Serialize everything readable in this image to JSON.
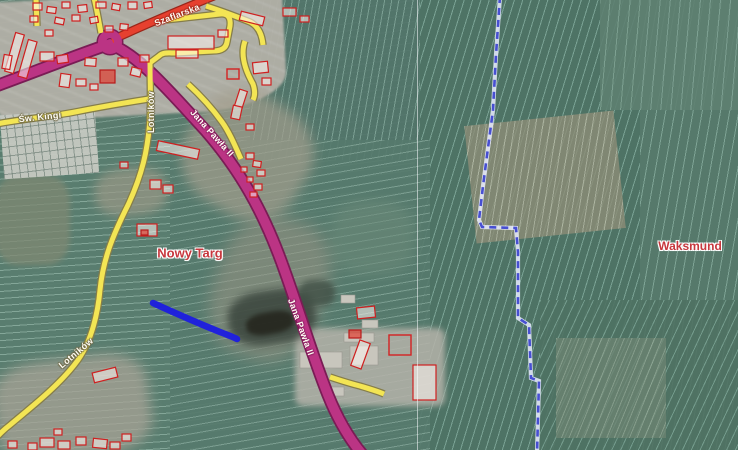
{
  "map_data": {
    "place_labels": [
      {
        "text": "Nowy Targ",
        "x": 190,
        "y": 253,
        "rot": 0,
        "size": 13
      },
      {
        "text": "Waksmund",
        "x": 690,
        "y": 246,
        "rot": 0,
        "size": 12
      }
    ],
    "road_labels": [
      {
        "text": "Szaflarska",
        "x": 177,
        "y": 15,
        "rot": -21,
        "cls": "halo-red"
      },
      {
        "text": "Św. Kingi",
        "x": 40,
        "y": 117,
        "rot": -6,
        "cls": "halo-yellow"
      },
      {
        "text": "Lotników",
        "x": 151,
        "y": 112,
        "rot": -90,
        "cls": "halo-yellow"
      },
      {
        "text": "Lotników",
        "x": 76,
        "y": 353,
        "rot": -40,
        "cls": "halo-yellow"
      },
      {
        "text": "Jana Pawła II",
        "x": 212,
        "y": 133,
        "rot": 48,
        "cls": "halo-magenta"
      },
      {
        "text": "Jana Pawła II",
        "x": 301,
        "y": 327,
        "rot": 70,
        "cls": "halo-magenta"
      }
    ],
    "colors": {
      "primary_road": "#bb3484",
      "primary_casing": "#7a1c55",
      "red_road": "#e6402f",
      "red_casing": "#99261a",
      "secondary_road": "#f3e554",
      "secondary_casing": "#857d4a",
      "boundary_blue": "#474fd2",
      "boundary_halo": "#e9ecff",
      "selected_way": "#1c1ce0",
      "building_red": "#cf2020",
      "place_label": "#c7373d"
    },
    "roads": [
      {
        "id": "jana-pawla-ii",
        "type": "primary",
        "d": "M-4,86 C45,68 85,52 110,44 C140,56 170,92 205,130 C240,170 262,210 280,258 C298,306 310,350 328,395 C340,425 352,442 362,454"
      },
      {
        "id": "szaflarska",
        "type": "trunk",
        "d": "M112,40 C140,27 175,12 214,-4"
      },
      {
        "id": "sw-kingi",
        "type": "secondary",
        "d": "M-4,124 C30,118 55,116 75,112 C105,106 130,102 149,99"
      },
      {
        "id": "lotnikow",
        "type": "secondary",
        "d": "M150,60 C150,85 151,100 150,118 C148,150 142,175 128,205 C112,237 103,260 100,290 C98,312 92,340 78,360 C60,385 30,408 10,425 C2,431 -2,436 -6,440"
      },
      {
        "id": "school-loop",
        "type": "secondary",
        "d": "M166,20 L220,14 C228,13 231,18 230,26 L227,42 C226,49 220,51 213,51 L175,53 C168,53 163,52 159,56 L151,62"
      },
      {
        "id": "roundabout-north",
        "type": "secondary",
        "d": "M101,33 C99,22 97,10 94,-2"
      },
      {
        "id": "top-stub",
        "type": "secondary",
        "d": "M37,26 L36,-2"
      },
      {
        "id": "east-1",
        "type": "secondary",
        "d": "M206,6 C225,12 240,18 250,22 C258,26 262,34 263,45"
      },
      {
        "id": "east-2",
        "type": "secondary",
        "d": "M245,41 C240,55 245,70 253,84 C255,90 255,96 253,100"
      },
      {
        "id": "east-3",
        "type": "secondary",
        "d": "M188,84 C200,95 212,108 222,122 C230,133 236,148 241,159"
      },
      {
        "id": "industrial-access",
        "type": "secondary",
        "d": "M330,377 C345,382 352,384 360,386 C370,389 377,391 384,394"
      }
    ],
    "roundabout": {
      "cx": 110,
      "cy": 42,
      "r": 8
    },
    "boundary": {
      "d": "M500,-4 L496,55 L493,110 L483,186 L479,220 L482,227 L516,228 L518,252 L518,318 L529,325 L531,378 L539,381 L537,454",
      "dash": "7 5"
    },
    "selected_way": {
      "d": "M153,303 C175,313 200,324 220,332 C228,335 233,337 237,339"
    },
    "seam_line": {
      "x": 417.5
    },
    "buildings": [
      [
        33,
        3,
        9,
        7,
        0,
        0
      ],
      [
        47,
        7,
        9,
        6,
        8,
        0
      ],
      [
        62,
        2,
        8,
        6,
        0,
        0
      ],
      [
        78,
        5,
        9,
        7,
        -6,
        0
      ],
      [
        96,
        2,
        10,
        6,
        0,
        0
      ],
      [
        112,
        4,
        8,
        6,
        10,
        0
      ],
      [
        128,
        2,
        9,
        7,
        0,
        0
      ],
      [
        144,
        2,
        8,
        6,
        -8,
        0
      ],
      [
        30,
        16,
        8,
        6,
        0,
        0
      ],
      [
        55,
        18,
        9,
        6,
        12,
        0
      ],
      [
        72,
        15,
        8,
        6,
        0,
        0
      ],
      [
        90,
        17,
        8,
        6,
        -10,
        0
      ],
      [
        105,
        26,
        8,
        6,
        0,
        0
      ],
      [
        120,
        24,
        8,
        6,
        6,
        0
      ],
      [
        45,
        30,
        8,
        6,
        0,
        0
      ],
      [
        10,
        33,
        9,
        40,
        16,
        0
      ],
      [
        23,
        40,
        9,
        38,
        16,
        0
      ],
      [
        3,
        55,
        8,
        14,
        10,
        0
      ],
      [
        40,
        52,
        14,
        9,
        0,
        0
      ],
      [
        57,
        55,
        11,
        8,
        -8,
        0
      ],
      [
        85,
        58,
        11,
        8,
        4,
        0
      ],
      [
        100,
        70,
        15,
        13,
        0,
        1
      ],
      [
        118,
        58,
        10,
        8,
        0,
        0
      ],
      [
        131,
        68,
        10,
        8,
        14,
        0
      ],
      [
        60,
        74,
        10,
        13,
        8,
        0
      ],
      [
        76,
        79,
        10,
        7,
        0,
        0
      ],
      [
        90,
        84,
        8,
        6,
        0,
        0
      ],
      [
        140,
        55,
        9,
        7,
        0,
        0
      ],
      [
        168,
        36,
        46,
        13,
        0,
        0
      ],
      [
        176,
        50,
        22,
        8,
        0,
        0
      ],
      [
        218,
        30,
        10,
        7,
        0,
        0
      ],
      [
        240,
        14,
        24,
        9,
        14,
        0
      ],
      [
        283,
        8,
        13,
        8,
        0,
        0
      ],
      [
        300,
        16,
        9,
        6,
        0,
        0
      ],
      [
        253,
        62,
        15,
        11,
        -6,
        0
      ],
      [
        227,
        69,
        12,
        10,
        0,
        2
      ],
      [
        262,
        78,
        9,
        7,
        0,
        0
      ],
      [
        237,
        90,
        8,
        17,
        18,
        0
      ],
      [
        232,
        106,
        9,
        13,
        12,
        0
      ],
      [
        246,
        124,
        8,
        6,
        0,
        0
      ],
      [
        157,
        145,
        42,
        10,
        12,
        0
      ],
      [
        150,
        180,
        11,
        9,
        0,
        0
      ],
      [
        163,
        185,
        10,
        8,
        0,
        0
      ],
      [
        120,
        162,
        8,
        6,
        0,
        0
      ],
      [
        137,
        224,
        20,
        12,
        0,
        0
      ],
      [
        141,
        230,
        7,
        5,
        0,
        1
      ],
      [
        246,
        153,
        8,
        6,
        0,
        0
      ],
      [
        253,
        161,
        8,
        6,
        8,
        0
      ],
      [
        241,
        167,
        6,
        5,
        0,
        0
      ],
      [
        257,
        170,
        8,
        6,
        0,
        0
      ],
      [
        247,
        177,
        6,
        5,
        0,
        0
      ],
      [
        254,
        184,
        8,
        6,
        0,
        0
      ],
      [
        250,
        192,
        7,
        5,
        0,
        0
      ],
      [
        357,
        307,
        18,
        11,
        -6,
        0
      ],
      [
        349,
        330,
        12,
        8,
        0,
        1
      ],
      [
        355,
        341,
        11,
        27,
        20,
        0
      ],
      [
        389,
        335,
        22,
        20,
        0,
        2
      ],
      [
        413,
        365,
        23,
        35,
        0,
        0
      ],
      [
        344,
        333,
        30,
        9,
        0,
        3
      ],
      [
        350,
        346,
        28,
        19,
        0,
        3
      ],
      [
        300,
        352,
        42,
        16,
        0,
        3
      ],
      [
        322,
        387,
        22,
        9,
        0,
        3
      ],
      [
        341,
        295,
        14,
        8,
        0,
        3
      ],
      [
        362,
        320,
        16,
        8,
        0,
        3
      ],
      [
        93,
        370,
        24,
        10,
        -14,
        0
      ],
      [
        40,
        438,
        14,
        9,
        0,
        0
      ],
      [
        58,
        441,
        12,
        8,
        0,
        0
      ],
      [
        76,
        437,
        10,
        8,
        0,
        0
      ],
      [
        93,
        439,
        14,
        9,
        6,
        0
      ],
      [
        110,
        442,
        10,
        7,
        0,
        0
      ],
      [
        54,
        429,
        8,
        6,
        0,
        0
      ],
      [
        28,
        443,
        9,
        7,
        0,
        0
      ],
      [
        8,
        441,
        9,
        7,
        0,
        0
      ],
      [
        122,
        434,
        9,
        7,
        0,
        0
      ]
    ],
    "terrain_patches": [
      {
        "x": -5,
        "y": -5,
        "w": 748,
        "h": 460,
        "rot": 0,
        "base": "#597b6d",
        "angle": 172,
        "stripe": "rgba(205,235,222,0.28)",
        "pitch": 7
      },
      {
        "x": 415,
        "y": -5,
        "w": 330,
        "h": 465,
        "rot": 0,
        "base": "#4e7365",
        "angle": 107,
        "stripe": "rgba(176,220,206,0.45)",
        "pitch": 8
      },
      {
        "x": 640,
        "y": -5,
        "w": 105,
        "h": 465,
        "rot": 0,
        "base": "#56796b",
        "angle": 100,
        "stripe": "rgba(186,226,211,0.4)",
        "pitch": 9
      },
      {
        "x": 600,
        "y": -5,
        "w": 140,
        "h": 115,
        "rot": 0,
        "base": "#5e8071",
        "angle": 95,
        "stripe": "rgba(190,225,210,0.35)",
        "pitch": 10,
        "op": 0.9
      },
      {
        "x": 470,
        "y": 118,
        "w": 150,
        "h": 118,
        "rot": -6,
        "base": "#8d8d77",
        "angle": 105,
        "stripe": "rgba(232,232,212,0.5)",
        "pitch": 7,
        "op": 0.8
      },
      {
        "x": 540,
        "y": 300,
        "w": 205,
        "h": 160,
        "rot": 0,
        "base": "#4f7263",
        "angle": 115,
        "stripe": "rgba(170,215,200,0.45)",
        "pitch": 8,
        "op": 0.9
      },
      {
        "x": 556,
        "y": 338,
        "w": 110,
        "h": 100,
        "rot": 0,
        "base": "#6d8472",
        "angle": 112,
        "stripe": "rgba(210,225,205,0.4)",
        "pitch": 7,
        "op": 0.75
      },
      {
        "x": 250,
        "y": -5,
        "w": 170,
        "h": 165,
        "rot": 0,
        "base": "#52756a",
        "angle": 100,
        "stripe": "rgba(190,228,214,0.4)",
        "pitch": 7,
        "op": 0.9
      },
      {
        "x": 150,
        "y": 140,
        "w": 280,
        "h": 320,
        "rot": 0,
        "base": "#567a6d",
        "angle": 170,
        "stripe": "rgba(200,232,219,0.35)",
        "pitch": 8,
        "op": 0.9
      },
      {
        "x": -5,
        "y": 130,
        "w": 175,
        "h": 330,
        "rot": 0,
        "base": "#5a7e70",
        "angle": 176,
        "stripe": "rgba(205,238,224,0.38)",
        "pitch": 7,
        "op": 0.95
      },
      {
        "x": -5,
        "y": 175,
        "w": 75,
        "h": 90,
        "rot": 0,
        "base": "#7f8872",
        "op": 0.75,
        "blur": 3,
        "round": "30%"
      },
      {
        "x": 330,
        "y": 200,
        "w": 85,
        "h": 75,
        "rot": 0,
        "base": "#6c8a79",
        "op": 0.55,
        "blur": 6,
        "round": "40%"
      },
      {
        "x": 95,
        "y": 168,
        "w": 72,
        "h": 48,
        "rot": -5,
        "base": "#9a9886",
        "op": 0.7,
        "blur": 5,
        "round": "40%"
      },
      {
        "x": -5,
        "y": -5,
        "w": 290,
        "h": 120,
        "rot": -3,
        "base": "#b2b0a7",
        "angle": 25,
        "stripe": "rgba(255,255,255,0.25)",
        "pitch": 11,
        "op": 0.95,
        "blur": 1,
        "round": "0 0 30% 10%"
      },
      {
        "x": 185,
        "y": 95,
        "w": 125,
        "h": 120,
        "rot": 32,
        "base": "#a39e8d",
        "op": 0.7,
        "blur": 6,
        "round": "40%"
      },
      {
        "x": 215,
        "y": 215,
        "w": 110,
        "h": 145,
        "rot": 20,
        "base": "#9a9484",
        "op": 0.55,
        "blur": 8,
        "round": "40%"
      },
      {
        "x": 295,
        "y": 328,
        "w": 150,
        "h": 78,
        "rot": 0,
        "base": "#b5b3aa",
        "op": 0.85,
        "blur": 3,
        "round": "8px"
      },
      {
        "x": -5,
        "y": 358,
        "w": 155,
        "h": 100,
        "rot": -8,
        "base": "#a8a396",
        "op": 0.75,
        "blur": 6,
        "round": "30%"
      },
      {
        "x": 228,
        "y": 290,
        "w": 88,
        "h": 54,
        "rot": -8,
        "base": "#3a453d",
        "op": 0.85,
        "blur": 4,
        "round": "40%"
      },
      {
        "x": 246,
        "y": 312,
        "w": 48,
        "h": 22,
        "rot": -10,
        "base": "#26271f",
        "op": 0.9,
        "blur": 2,
        "round": "40%"
      },
      {
        "x": 299,
        "y": 280,
        "w": 36,
        "h": 26,
        "rot": 0,
        "base": "#415046",
        "op": 0.8,
        "blur": 3,
        "round": "40%"
      },
      {
        "x": 2,
        "y": 112,
        "w": 95,
        "h": 64,
        "rot": -4,
        "base": "#c6c9c2",
        "grid": true,
        "op": 0.95
      }
    ]
  }
}
